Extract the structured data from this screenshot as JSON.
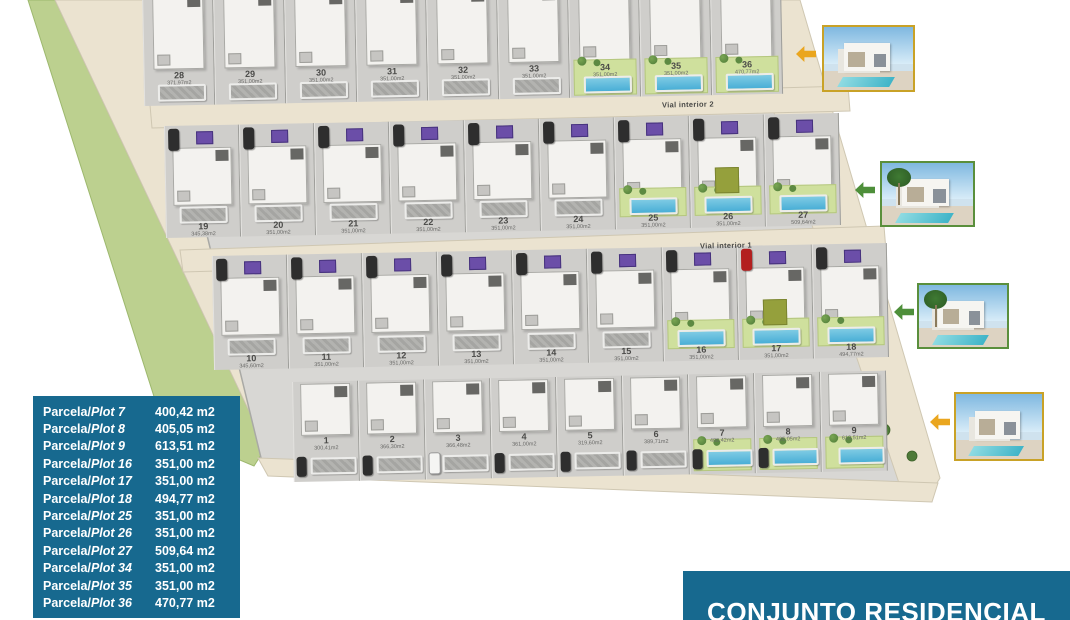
{
  "legend": {
    "bg_color": "#17698f",
    "items": [
      {
        "prefix": "Parcela/",
        "plot": "Plot 7",
        "area": "400,42 m2"
      },
      {
        "prefix": "Parcela/",
        "plot": "Plot 8",
        "area": "405,05 m2"
      },
      {
        "prefix": "Parcela/",
        "plot": "Plot 9",
        "area": "613,51 m2"
      },
      {
        "prefix": "Parcela/",
        "plot": "Plot 16",
        "area": "351,00 m2"
      },
      {
        "prefix": "Parcela/",
        "plot": "Plot 17",
        "area": "351,00 m2"
      },
      {
        "prefix": "Parcela/",
        "plot": "Plot 18",
        "area": "494,77 m2"
      },
      {
        "prefix": "Parcela/",
        "plot": "Plot 25",
        "area": "351,00 m2"
      },
      {
        "prefix": "Parcela/",
        "plot": "Plot 26",
        "area": "351,00 m2"
      },
      {
        "prefix": "Parcela/",
        "plot": "Plot 27",
        "area": "509,64 m2"
      },
      {
        "prefix": "Parcela/",
        "plot": "Plot 34",
        "area": "351,00 m2"
      },
      {
        "prefix": "Parcela/",
        "plot": "Plot 35",
        "area": "351,00 m2"
      },
      {
        "prefix": "Parcela/",
        "plot": "Plot 36",
        "area": "470,77 m2"
      }
    ]
  },
  "title_box": {
    "text": "CONJUNTO RESIDENCIAL",
    "bg_color": "#17698f",
    "text_color": "#ffffff"
  },
  "roads": {
    "vial_interior_2": "Vial interior 2",
    "vial_interior_1": "Vial interior 1"
  },
  "site_plan": {
    "rows": [
      {
        "name": "plots-28-36",
        "plots": [
          {
            "num": "28",
            "area": "371,97m2",
            "hl": false
          },
          {
            "num": "29",
            "area": "351,00m2",
            "hl": false
          },
          {
            "num": "30",
            "area": "351,00m2",
            "hl": false
          },
          {
            "num": "31",
            "area": "351,00m2",
            "hl": false
          },
          {
            "num": "32",
            "area": "351,00m2",
            "hl": false
          },
          {
            "num": "33",
            "area": "351,00m2",
            "hl": false
          },
          {
            "num": "34",
            "area": "351,00m2",
            "hl": true
          },
          {
            "num": "35",
            "area": "351,00m2",
            "hl": true
          },
          {
            "num": "36",
            "area": "470,77m2",
            "hl": true
          }
        ]
      },
      {
        "name": "plots-19-27",
        "plots": [
          {
            "num": "19",
            "area": "345,38m2",
            "hl": false,
            "car": "dark",
            "panel": true
          },
          {
            "num": "20",
            "area": "351,00m2",
            "hl": false,
            "car": "dark",
            "panel": true
          },
          {
            "num": "21",
            "area": "351,00m2",
            "hl": false,
            "car": "dark",
            "panel": true
          },
          {
            "num": "22",
            "area": "351,00m2",
            "hl": false,
            "car": "dark",
            "panel": true
          },
          {
            "num": "23",
            "area": "351,00m2",
            "hl": false,
            "car": "dark",
            "panel": true
          },
          {
            "num": "24",
            "area": "351,00m2",
            "hl": false,
            "car": "dark",
            "panel": true
          },
          {
            "num": "25",
            "area": "351,00m2",
            "hl": true,
            "car": "dark",
            "panel": true
          },
          {
            "num": "26",
            "area": "351,00m2",
            "hl": true,
            "car": "dark",
            "panel": true,
            "olive": true
          },
          {
            "num": "27",
            "area": "509,64m2",
            "hl": true,
            "car": "dark",
            "panel": true
          }
        ]
      },
      {
        "name": "plots-10-18",
        "plots": [
          {
            "num": "10",
            "area": "345,60m2",
            "hl": false,
            "car": "dark",
            "panel": true
          },
          {
            "num": "11",
            "area": "351,00m2",
            "hl": false,
            "car": "dark",
            "panel": true
          },
          {
            "num": "12",
            "area": "351,00m2",
            "hl": false,
            "car": "dark",
            "panel": true
          },
          {
            "num": "13",
            "area": "351,00m2",
            "hl": false,
            "car": "dark",
            "panel": true
          },
          {
            "num": "14",
            "area": "351,00m2",
            "hl": false,
            "car": "dark",
            "panel": true
          },
          {
            "num": "15",
            "area": "351,00m2",
            "hl": false,
            "car": "dark",
            "panel": true
          },
          {
            "num": "16",
            "area": "351,00m2",
            "hl": true,
            "car": "dark",
            "panel": true
          },
          {
            "num": "17",
            "area": "351,00m2",
            "hl": true,
            "car": "red",
            "panel": true,
            "olive": true
          },
          {
            "num": "18",
            "area": "494,77m2",
            "hl": true,
            "car": "dark",
            "panel": true
          }
        ]
      },
      {
        "name": "plots-1-9",
        "plots": [
          {
            "num": "1",
            "area": "300,41m2",
            "hl": false,
            "car": "dark"
          },
          {
            "num": "2",
            "area": "366,30m2",
            "hl": false,
            "car": "dark"
          },
          {
            "num": "3",
            "area": "366,48m2",
            "hl": false,
            "car": "white"
          },
          {
            "num": "4",
            "area": "361,00m2",
            "hl": false,
            "car": "dark"
          },
          {
            "num": "5",
            "area": "319,60m2",
            "hl": false,
            "car": "dark"
          },
          {
            "num": "6",
            "area": "389,71m2",
            "hl": false,
            "car": "dark"
          },
          {
            "num": "7",
            "area": "400,42m2",
            "hl": true,
            "car": "dark"
          },
          {
            "num": "8",
            "area": "405,05m2",
            "hl": true,
            "car": "dark"
          },
          {
            "num": "9",
            "area": "613,51m2",
            "hl": true
          }
        ]
      }
    ]
  },
  "photos": [
    {
      "name": "villa-render-1",
      "border_color": "#c9a227",
      "arrow_color": "#eaa61f",
      "palm": false
    },
    {
      "name": "villa-render-2",
      "border_color": "#5a8f3c",
      "arrow_color": "#4e8f3a",
      "palm": true
    },
    {
      "name": "villa-render-3",
      "border_color": "#5a8f3c",
      "arrow_color": "#4e8f3a",
      "palm": true
    },
    {
      "name": "villa-render-4",
      "border_color": "#c9a227",
      "arrow_color": "#eaa61f",
      "palm": false
    }
  ],
  "colors": {
    "plan_gray": "#d8d7d4",
    "road_beige": "#ebe3d0",
    "green_band": "#bcd08f",
    "garden_green": "#cfe09d",
    "pool_blue": "#49aed6",
    "accent_purple": "#6b4ea8",
    "legend_blue": "#17698f"
  }
}
